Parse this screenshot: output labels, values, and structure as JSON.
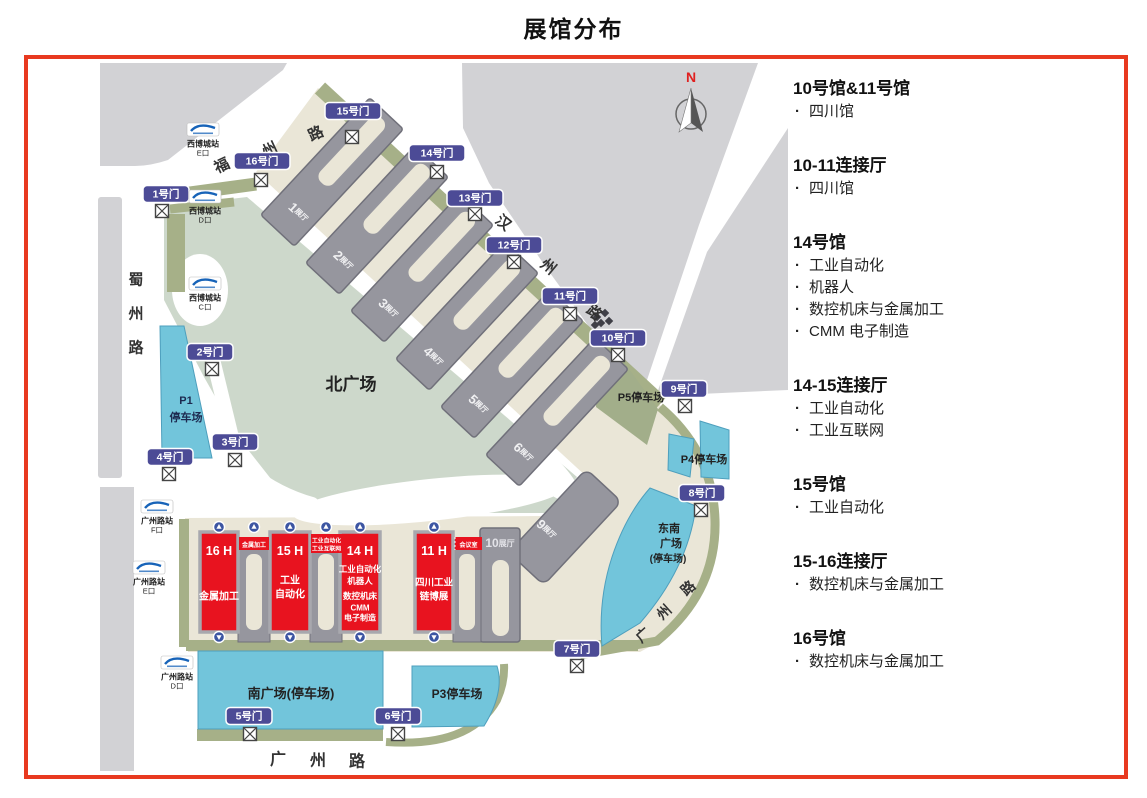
{
  "title": "展馆分布",
  "compass": {
    "north_label": "N"
  },
  "map": {
    "gates": [
      "1号门",
      "2号门",
      "3号门",
      "4号门",
      "5号门",
      "6号门",
      "7号门",
      "8号门",
      "9号门",
      "10号门",
      "11号门",
      "12号门",
      "13号门",
      "14号门",
      "15号门",
      "16号门"
    ],
    "metro_stations": [
      {
        "name": "西博城站",
        "exit": "E口"
      },
      {
        "name": "西博城站",
        "exit": "D口"
      },
      {
        "name": "西博城站",
        "exit": "C口"
      },
      {
        "name": "广州路站",
        "exit": "F口"
      },
      {
        "name": "广州路站",
        "exit": "E口"
      },
      {
        "name": "广州路站",
        "exit": "D口"
      }
    ],
    "roads": {
      "fuzhou": [
        "福",
        "州",
        "路"
      ],
      "shuzhou": [
        "蜀",
        "州",
        "路"
      ],
      "hanzhou": [
        "汉",
        "州",
        "路"
      ],
      "guangzhou_bottom": [
        "广",
        "州",
        "路"
      ],
      "guangzhou_diag": [
        "广",
        "州",
        "路"
      ]
    },
    "plazas": {
      "north": "北广场",
      "south": "南广场(停车场)",
      "southeast": [
        "东南",
        "广场",
        "(停车场)"
      ]
    },
    "parkings": {
      "p1": [
        "P1",
        "停车场"
      ],
      "p3": "P3停车场",
      "p4": "P4停车场",
      "p5": "P5停车场"
    },
    "gray_halls": [
      {
        "num": "1",
        "suffix": "展厅"
      },
      {
        "num": "2",
        "suffix": "展厅"
      },
      {
        "num": "3",
        "suffix": "展厅"
      },
      {
        "num": "4",
        "suffix": "展厅"
      },
      {
        "num": "5",
        "suffix": "展厅"
      },
      {
        "num": "6",
        "suffix": "展厅"
      },
      {
        "num": "9",
        "suffix": "展厅"
      },
      {
        "num": "10",
        "suffix": "展厅"
      }
    ],
    "red_halls": [
      {
        "id": "16 H",
        "lines": [
          "金属加工"
        ]
      },
      {
        "id": "15 H",
        "lines": [
          "工业",
          "自动化"
        ]
      },
      {
        "id": "14 H",
        "lines": [
          "工业自动化",
          "机器人",
          "数控机床",
          "CMM",
          "电子制造"
        ]
      },
      {
        "id": "11 H",
        "lines": [
          "四川工业",
          "链博展"
        ]
      }
    ],
    "red_connectors": [
      {
        "lines": [
          "金属加工"
        ]
      },
      {
        "lines": [
          "工业自动化",
          "工业互联网"
        ]
      },
      {
        "lines": [
          "会议室"
        ]
      }
    ]
  },
  "legend": {
    "sections": [
      {
        "heading": "10号馆&11号馆",
        "items": [
          "四川馆"
        ]
      },
      {
        "heading": "10-11连接厅",
        "items": [
          "四川馆"
        ]
      },
      {
        "heading": "14号馆",
        "items": [
          "工业自动化",
          "机器人",
          "数控机床与金属加工",
          "CMM 电子制造"
        ]
      },
      {
        "heading": "14-15连接厅",
        "items": [
          "工业自动化",
          "工业互联网"
        ]
      },
      {
        "heading": "15号馆",
        "items": [
          "工业自动化"
        ]
      },
      {
        "heading": "15-16连接厅",
        "items": [
          "数控机床与金属加工"
        ]
      },
      {
        "heading": "16号馆",
        "items": [
          "数控机床与金属加工"
        ]
      }
    ]
  },
  "colors": {
    "border": "#e8391f",
    "gate_badge": "#4c4b96",
    "hall_red": "#e8131f",
    "venue_cream": "#eae6d7",
    "plaza_sage": "#cdd8cb",
    "parking_blue": "#72c5db",
    "olive": "#a6b088",
    "block_gray": "#d2d2d5",
    "hall_gray": "#96969e",
    "metro_blue": "#1763b8"
  }
}
